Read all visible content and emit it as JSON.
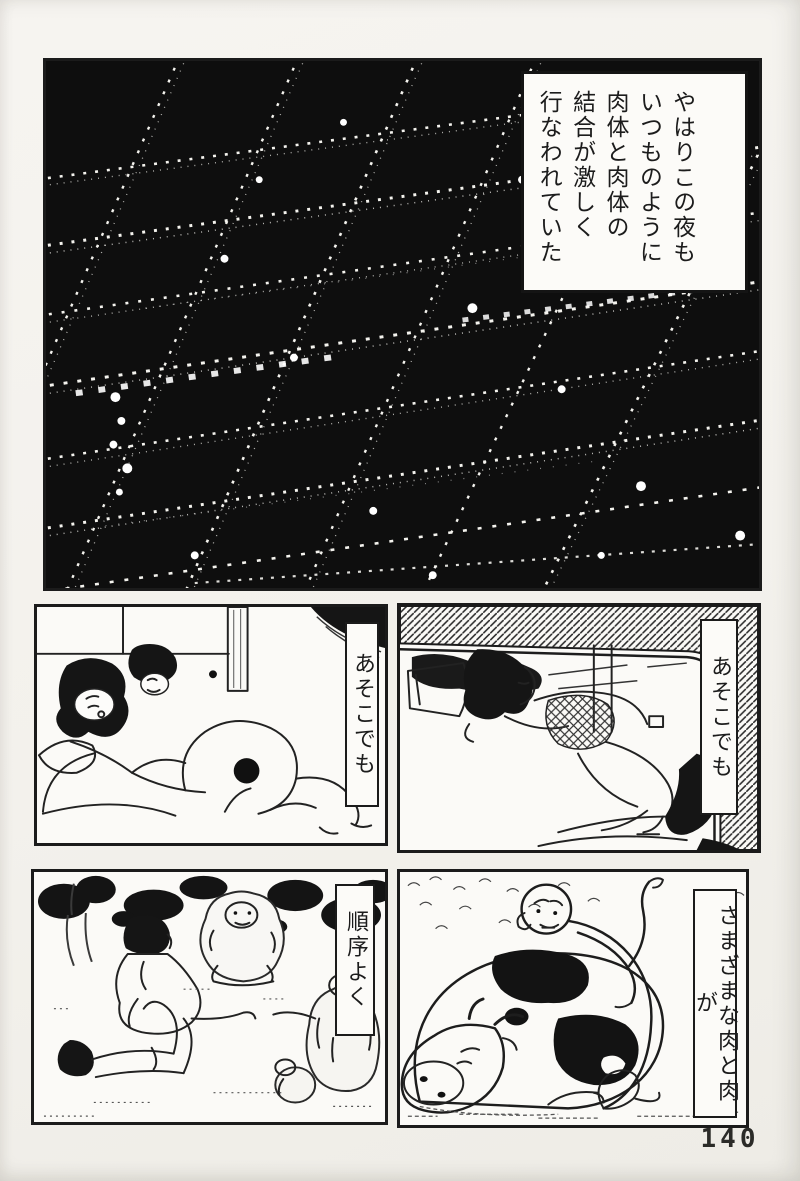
{
  "page": {
    "number": "140",
    "paper_color": "#f3f1ec",
    "ink_color": "#1b1b1b"
  },
  "panels": {
    "city": {
      "alt": "Aerial night view of a city: dark blocks in a slanted grid, streets traced by strings of small lights",
      "caption": "やはりこの夜も\nいつものように\n肉体と肉体の\n結合が激しく\n行なわれていた"
    },
    "bedroom": {
      "alt": "Interior of a tatami room with futon and figures",
      "caption": "あそこでも"
    },
    "car": {
      "alt": "Interior of a parked car seen through the windshield",
      "caption": "あそこでも"
    },
    "park": {
      "alt": "Grove scene with children and monkeys among bushes",
      "caption": "順序よく"
    },
    "cow": {
      "alt": "Bald man crouching behind a reclining spotted cow",
      "caption": "さまざまな肉と肉が"
    }
  }
}
